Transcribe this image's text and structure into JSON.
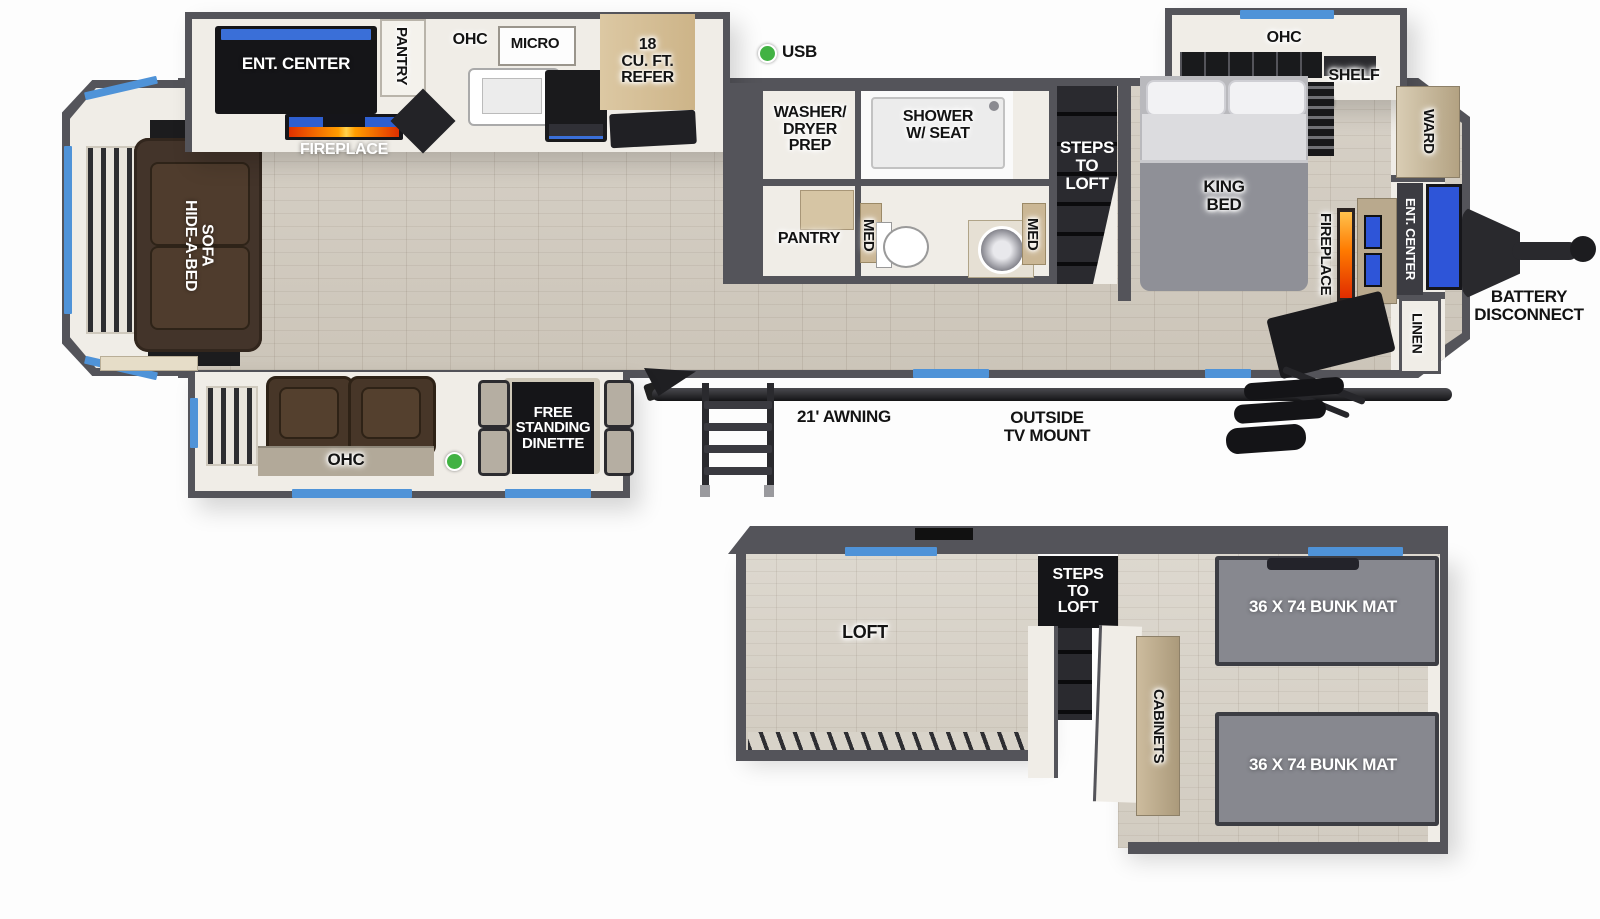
{
  "title": "RV travel trailer floorplan with loft",
  "colors": {
    "wall_gray": "#54545a",
    "floor_wood": "#d2cbc0",
    "interior_cream": "#f0ede7",
    "window_blue": "#4f93d8",
    "usb_green": "#41b243",
    "flame_orange": "#ff7a00",
    "tv_blue": "#2e55d8",
    "furniture_brown": "#473628",
    "mat_gray": "#87888f"
  },
  "main": {
    "kitchen": {
      "ent_center": "ENT. CENTER",
      "fireplace": "FIREPLACE",
      "pantry": "PANTRY",
      "ohc": "OHC",
      "micro": "MICRO",
      "refer": "18\nCU. FT.\nREFER"
    },
    "usb": "USB",
    "rear": {
      "sofa": "HIDE-A-BED\nSOFA"
    },
    "bath": {
      "washer": "WASHER/\nDRYER\nPREP",
      "shower": "SHOWER\nW/ SEAT",
      "pantry": "PANTRY",
      "med_left": "MED",
      "med_right": "MED"
    },
    "steps_to_loft": "STEPS\nTO\nLOFT",
    "bedroom": {
      "ohc": "OHC",
      "shelf": "SHELF",
      "king_bed": "KING\nBED",
      "ward": "WARD",
      "fireplace": "FIREPLACE",
      "ent_center": "ENT. CENTER",
      "linen": "LINEN"
    },
    "front": {
      "battery": "BATTERY\nDISCONNECT"
    },
    "slide": {
      "ohc": "OHC",
      "dinette": "FREE\nSTANDING\nDINETTE"
    },
    "exterior": {
      "awning": "21' AWNING",
      "tv_mount": "OUTSIDE\nTV MOUNT"
    }
  },
  "loft": {
    "loft": "LOFT",
    "steps": "STEPS\nTO\nLOFT",
    "cabinets": "CABINETS",
    "bunk_top": "36 X 74 BUNK MAT",
    "bunk_bottom": "36 X 74 BUNK MAT"
  }
}
